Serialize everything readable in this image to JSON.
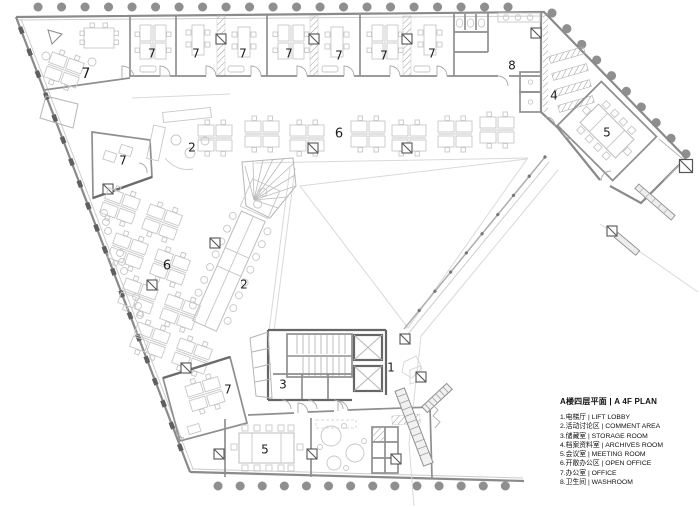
{
  "plan": {
    "colors": {
      "wall": "#8a8a8a",
      "dark": "#5f5f5f",
      "furniture": "#bdbdbd",
      "label": "#1c1c1c",
      "background": "#ffffff"
    },
    "room_labels": [
      {
        "n": "7",
        "x": 86,
        "y": 74,
        "s": 14
      },
      {
        "n": "7",
        "x": 152,
        "y": 54,
        "s": 12
      },
      {
        "n": "7",
        "x": 196,
        "y": 54,
        "s": 12
      },
      {
        "n": "7",
        "x": 243,
        "y": 54,
        "s": 12
      },
      {
        "n": "7",
        "x": 289,
        "y": 54,
        "s": 12
      },
      {
        "n": "7",
        "x": 339,
        "y": 56,
        "s": 12
      },
      {
        "n": "7",
        "x": 384,
        "y": 56,
        "s": 12
      },
      {
        "n": "7",
        "x": 432,
        "y": 54,
        "s": 12
      },
      {
        "n": "8",
        "x": 512,
        "y": 66,
        "s": 12
      },
      {
        "n": "4",
        "x": 554,
        "y": 96,
        "s": 12
      },
      {
        "n": "5",
        "x": 607,
        "y": 133,
        "s": 12
      },
      {
        "n": "2",
        "x": 192,
        "y": 148,
        "s": 12
      },
      {
        "n": "6",
        "x": 339,
        "y": 134,
        "s": 13
      },
      {
        "n": "7",
        "x": 123,
        "y": 161,
        "s": 12
      },
      {
        "n": "6",
        "x": 167,
        "y": 266,
        "s": 13
      },
      {
        "n": "2",
        "x": 244,
        "y": 285,
        "s": 12
      },
      {
        "n": "7",
        "x": 228,
        "y": 390,
        "s": 12
      },
      {
        "n": "3",
        "x": 283,
        "y": 385,
        "s": 12
      },
      {
        "n": "1",
        "x": 391,
        "y": 368,
        "s": 12
      },
      {
        "n": "5",
        "x": 265,
        "y": 450,
        "s": 12
      }
    ]
  },
  "legend": {
    "title": "A楼四层平面 | A 4F PLAN",
    "items": [
      "1.电梯厅 | LIFT LOBBY",
      "2.活动讨论区 | COMMENT AREA",
      "3.储藏室 | STORAGE ROOM",
      "4.档案资料室 | ARCHIVES ROOM",
      "5.会议室 | MEETING ROOM",
      "6.开敞办公区 | OPEN OFFICE",
      "7.办公室 | OFFICE",
      "8.卫生间 | WASHROOM"
    ]
  }
}
